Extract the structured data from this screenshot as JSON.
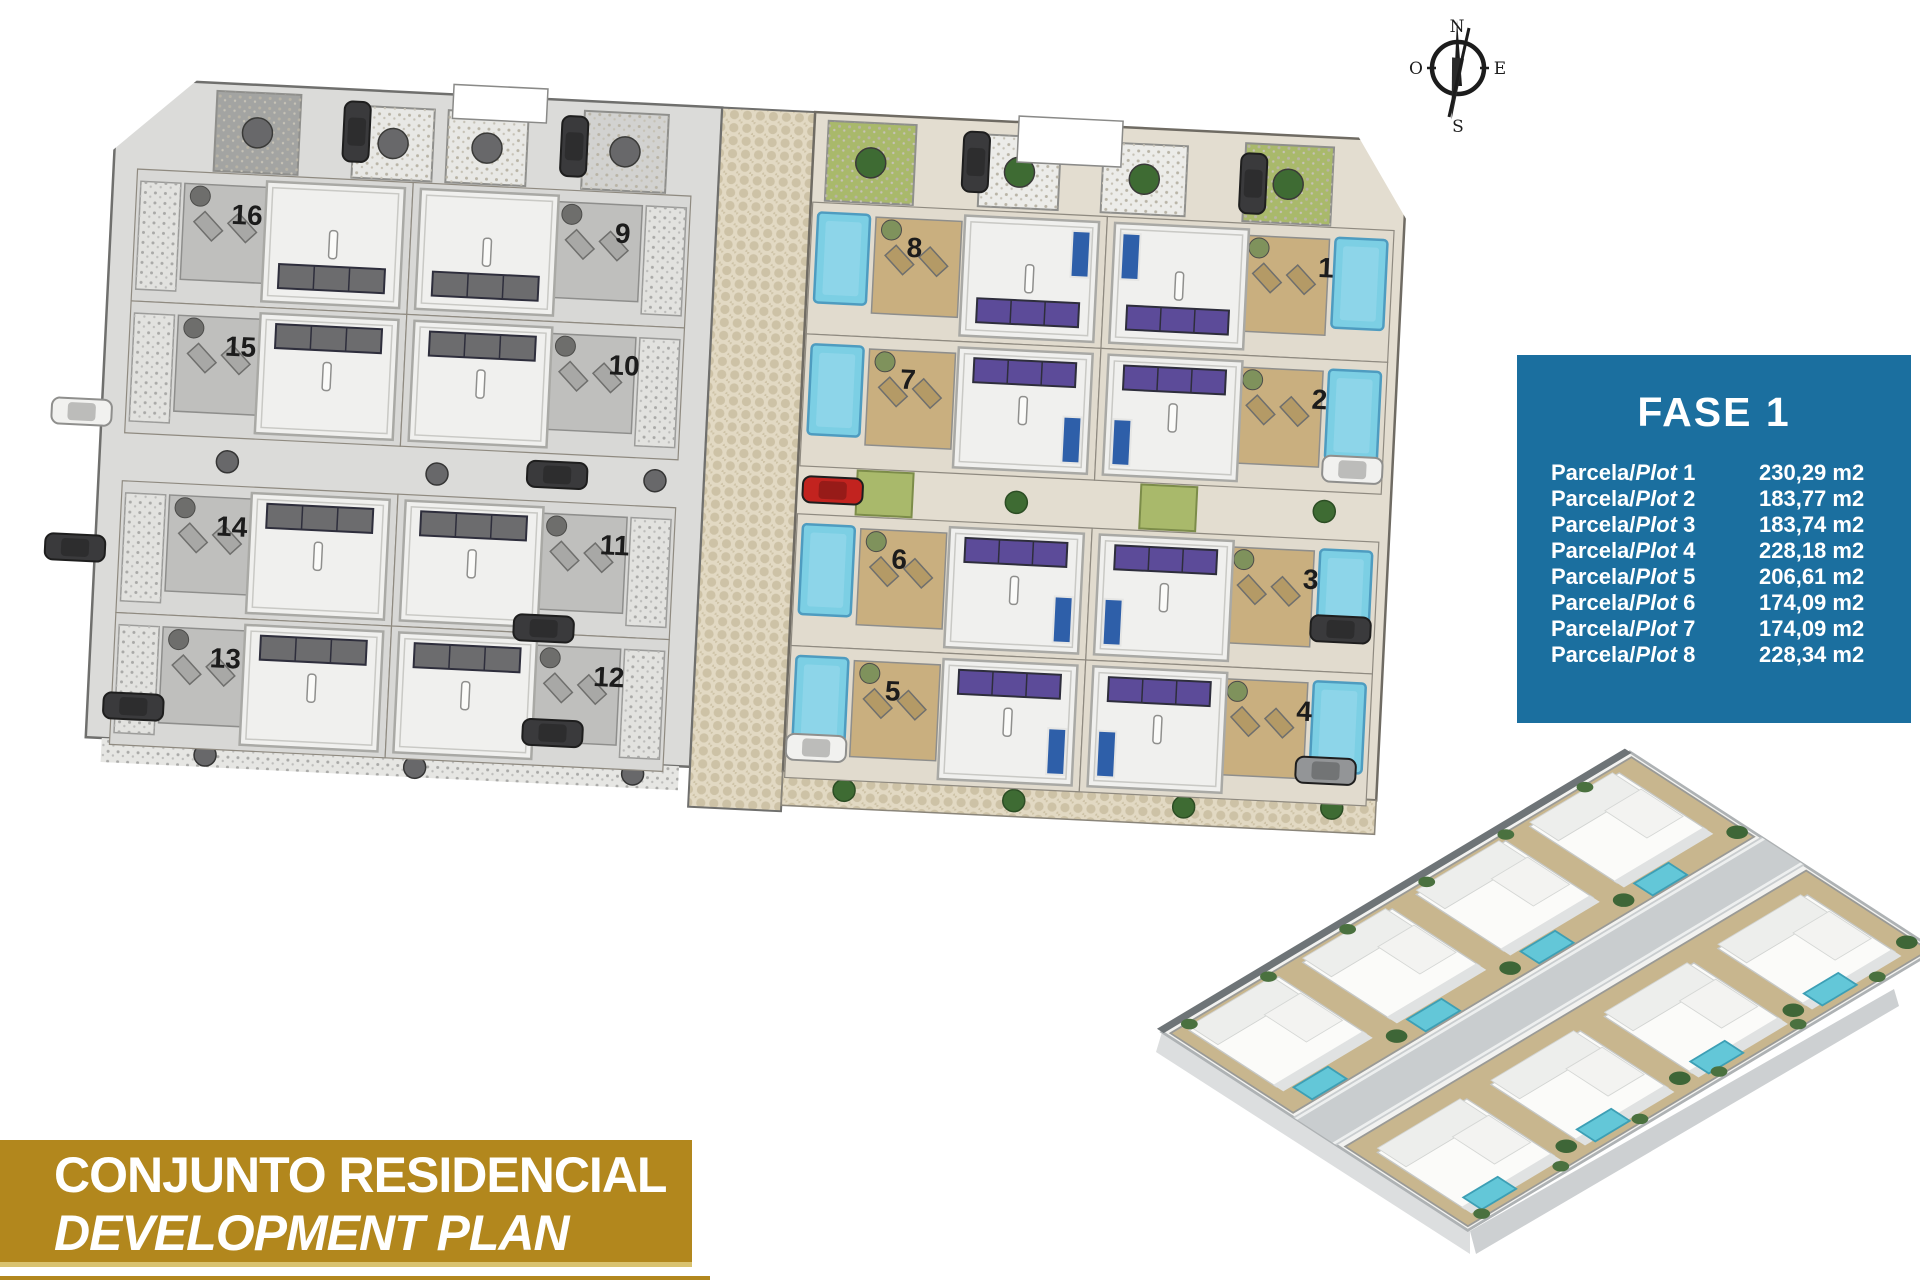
{
  "fase_box": {
    "title": "FASE 1",
    "rows": [
      {
        "label_regular": "Parcela/",
        "label_italic": "Plot",
        "number": "1",
        "area": "230,29 m2"
      },
      {
        "label_regular": "Parcela/",
        "label_italic": "Plot",
        "number": "2",
        "area": "183,77 m2"
      },
      {
        "label_regular": "Parcela/",
        "label_italic": "Plot",
        "number": "3",
        "area": "183,74 m2"
      },
      {
        "label_regular": "Parcela/",
        "label_italic": "Plot",
        "number": "4",
        "area": "228,18 m2"
      },
      {
        "label_regular": "Parcela/",
        "label_italic": "Plot",
        "number": "5",
        "area": "206,61 m2"
      },
      {
        "label_regular": "Parcela/",
        "label_italic": "Plot",
        "number": "6",
        "area": "174,09 m2"
      },
      {
        "label_regular": "Parcela/",
        "label_italic": "Plot",
        "number": "7",
        "area": "174,09 m2"
      },
      {
        "label_regular": "Parcela/",
        "label_italic": "Plot",
        "number": "8",
        "area": "228,34 m2"
      }
    ]
  },
  "banner": {
    "line1": "CONJUNTO RESIDENCIAL",
    "line2": "DEVELOPMENT PLAN"
  },
  "compass": {
    "north": "N",
    "south": "S",
    "east": "E",
    "west": "O"
  },
  "site_plan": {
    "gray_section_plots": [
      [
        "16",
        "15",
        "14",
        "13"
      ],
      [
        "9",
        "10",
        "11",
        "12"
      ]
    ],
    "phase_section_plots": [
      [
        "8",
        "7",
        "6",
        "5"
      ],
      [
        "1",
        "2",
        "3",
        "4"
      ]
    ],
    "cars": [
      {
        "x": 228,
        "y": 12,
        "o": "v",
        "c": "dark"
      },
      {
        "x": 446,
        "y": 16,
        "o": "v",
        "c": "dark"
      },
      {
        "x": 848,
        "y": 12,
        "o": "v",
        "c": "dark"
      },
      {
        "x": 1126,
        "y": 20,
        "o": "v",
        "c": "dark"
      },
      {
        "x": -50,
        "y": 322,
        "o": "h",
        "c": "white"
      },
      {
        "x": -50,
        "y": 458,
        "o": "h",
        "c": "dark"
      },
      {
        "x": 16,
        "y": 614,
        "o": "h",
        "c": "dark"
      },
      {
        "x": 428,
        "y": 362,
        "o": "h",
        "c": "dark"
      },
      {
        "x": 422,
        "y": 516,
        "o": "h",
        "c": "dark"
      },
      {
        "x": 436,
        "y": 620,
        "o": "h",
        "c": "dark"
      },
      {
        "x": 704,
        "y": 364,
        "o": "h",
        "c": "red"
      },
      {
        "x": 700,
        "y": 622,
        "o": "h",
        "c": "white"
      },
      {
        "x": 1222,
        "y": 318,
        "o": "h",
        "c": "white"
      },
      {
        "x": 1218,
        "y": 478,
        "o": "h",
        "c": "dark"
      },
      {
        "x": 1210,
        "y": 620,
        "o": "h",
        "c": "gray"
      }
    ]
  },
  "colors": {
    "fase_blue": "#1B6F9F",
    "banner_gold": "#B2871D",
    "banner_gold_light": "#D9C26E",
    "pool_cyan": "#7CCFE4",
    "pool_edge": "#4E9CC0",
    "solar_purple": "#5C4B99",
    "lawn_green": "#A9B96B",
    "tree_green": "#3E6B33",
    "tree_olive": "#7F925C",
    "tree_gray": "#68686A",
    "terrace_beige": "#C9AF7F",
    "lounger_beige": "#B49A66",
    "cobble_base": "#E2D9C3",
    "cobble_stone": "#CDC2A6",
    "gray_plot": "#DBDBD9",
    "phase_plot": "#E3DDD0",
    "house_white": "#F0F0EE",
    "door_blue": "#2E5FA9",
    "car_dark": "#3A3A3C",
    "car_white": "#F1F1EF",
    "car_gray": "#939597",
    "car_red": "#C2231F"
  }
}
